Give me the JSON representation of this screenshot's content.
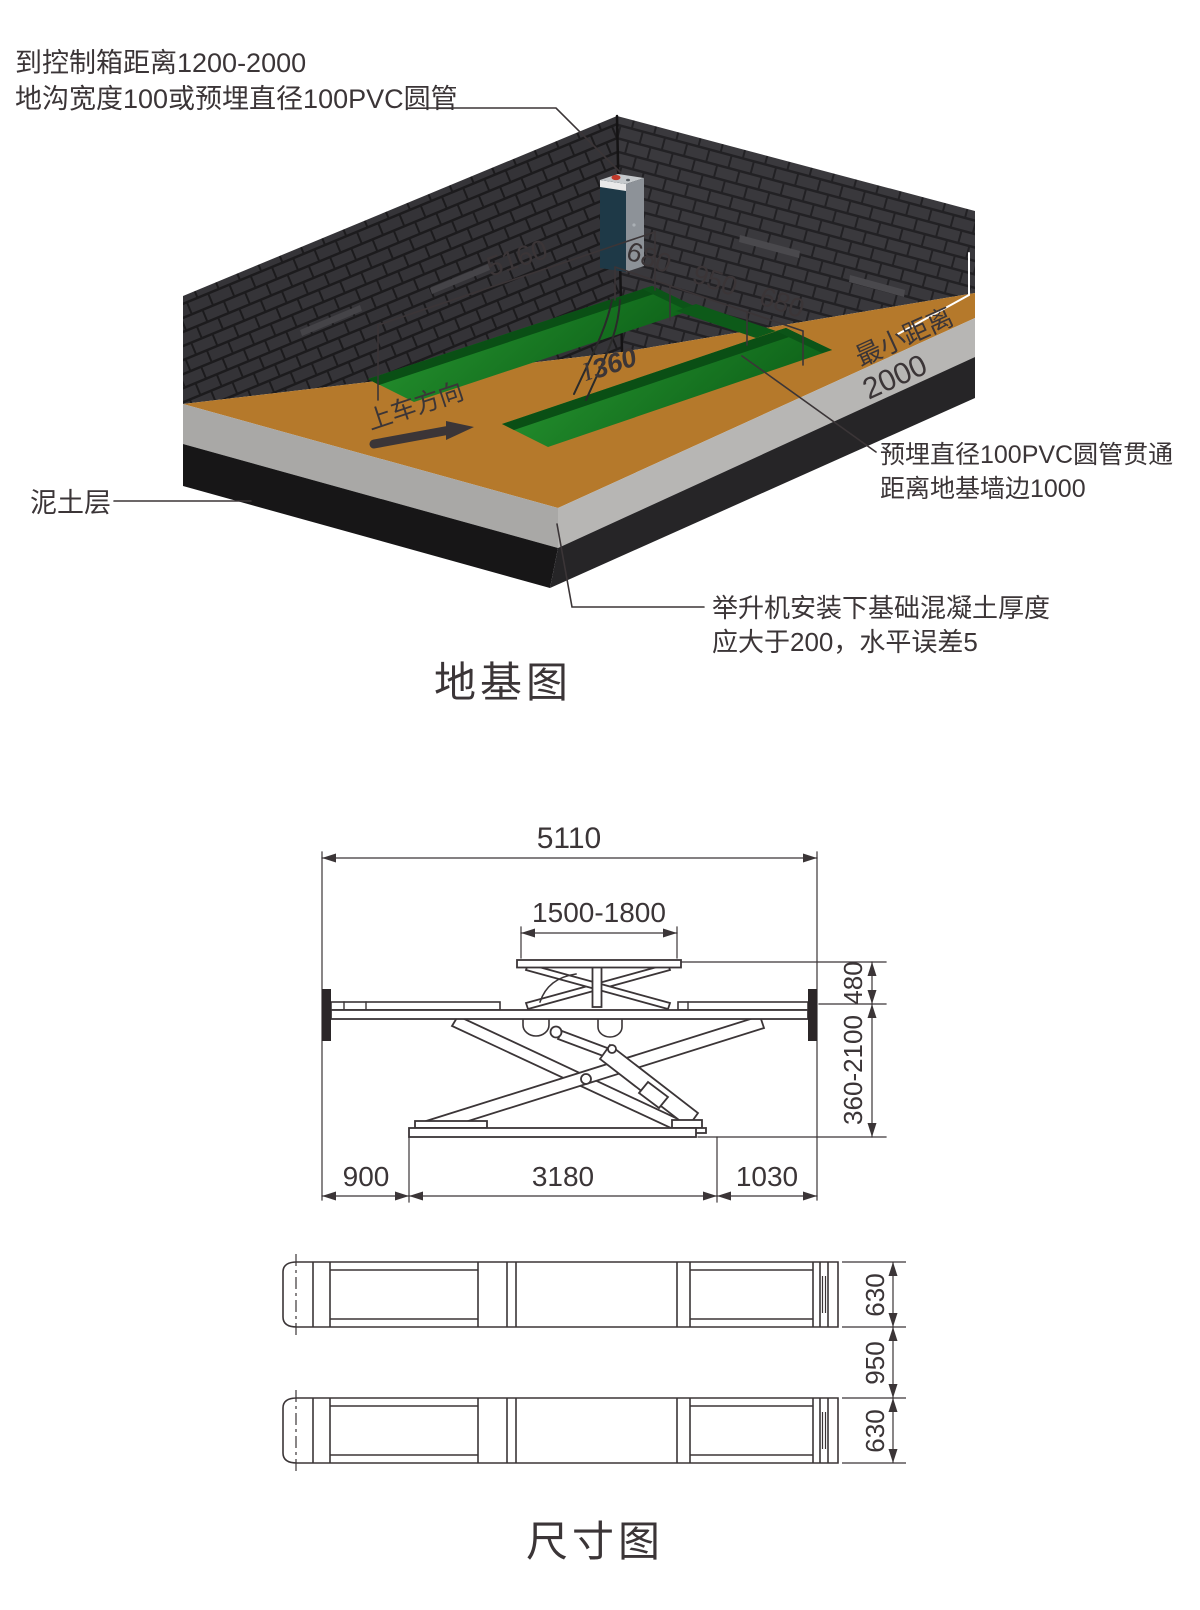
{
  "foundation_view": {
    "title": "地基图",
    "callout_control_box_line1": "到控制箱距离1200-2000",
    "callout_control_box_line2": "地沟宽度100或预埋直径100PVC圆管",
    "soil_label": "泥土层",
    "callout_pvc_line1": "预埋直径100PVC圆管贯通",
    "callout_pvc_line2": "距离地基墙边1000",
    "callout_concrete_line1": "举升机安装下基础混凝土厚度",
    "callout_concrete_line2": "应大于200，水平误差5",
    "dim_pit_length": "5160",
    "dim_pit_width_left": "680",
    "dim_pit_gap": "950",
    "dim_pit_width_right": "680",
    "pit_depth": "360",
    "pit_depth_cursor": "I",
    "min_distance_label": "最小距离",
    "min_distance_value": "2000",
    "drive_direction": "上车方向"
  },
  "dimension_view": {
    "title": "尺寸图",
    "overall_length": "5110",
    "upper_platform_range": "1500-1800",
    "platform_thickness": "480",
    "lift_height_range": "360-2100",
    "left_offset": "900",
    "base_length": "3180",
    "right_offset": "1030",
    "platform_width_top": "630",
    "platform_gap": "950",
    "platform_width_bottom": "630"
  },
  "colors": {
    "floor": "#b5792b",
    "wall_dark": "#29282a",
    "pit_green_bright": "#27a032",
    "pit_green_dark": "#0a4f15",
    "concrete_gray": "#b3b2b0",
    "soil_black": "#1d1c1d",
    "control_box_teal": "#1e3947",
    "line_dark": "#3b3537",
    "highlight_white": "#ffffff"
  }
}
